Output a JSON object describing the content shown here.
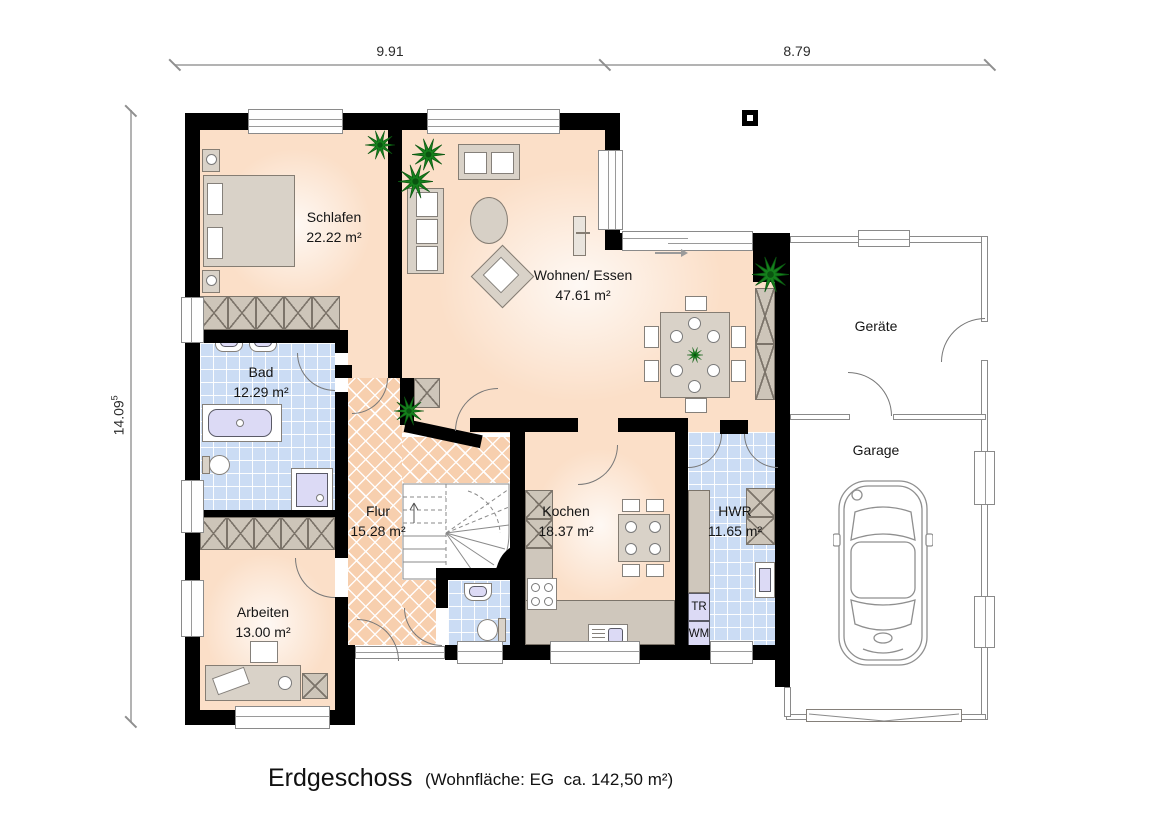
{
  "title": {
    "floor_label": "Erdgeschoss",
    "area_note": "(Wohnfläche: EG  ca. 142,50 m²)"
  },
  "dimensions": {
    "top_left": "9.91",
    "top_right": "8.79",
    "left_value": "14.09",
    "left_superscript": "5"
  },
  "rooms": {
    "schlafen": {
      "name": "Schlafen",
      "area": "22.22 m²"
    },
    "wohnen_essen": {
      "name": "Wohnen/ Essen",
      "area": "47.61 m²"
    },
    "bad": {
      "name": "Bad",
      "area": "12.29 m²"
    },
    "flur": {
      "name": "Flur",
      "area": "15.28 m²"
    },
    "arbeiten": {
      "name": "Arbeiten",
      "area": "13.00 m²"
    },
    "kochen": {
      "name": "Kochen",
      "area": "18.37 m²"
    },
    "hwr": {
      "name": "HWR",
      "area": "11.65 m²"
    },
    "geraete": {
      "name": "Geräte"
    },
    "garage": {
      "name": "Garage"
    }
  },
  "appliances": {
    "dryer": "TR",
    "washer": "WM"
  },
  "colors": {
    "wall": "#000000",
    "floor_living": "#fbdfc8",
    "floor_hall": "#f7cfae",
    "floor_tile": "#cbdcf4",
    "furniture": "#d9d2c8",
    "appliance": "#dcdaf5",
    "plant": "#15801c",
    "thin_wall_line": "#8a8a8a"
  }
}
